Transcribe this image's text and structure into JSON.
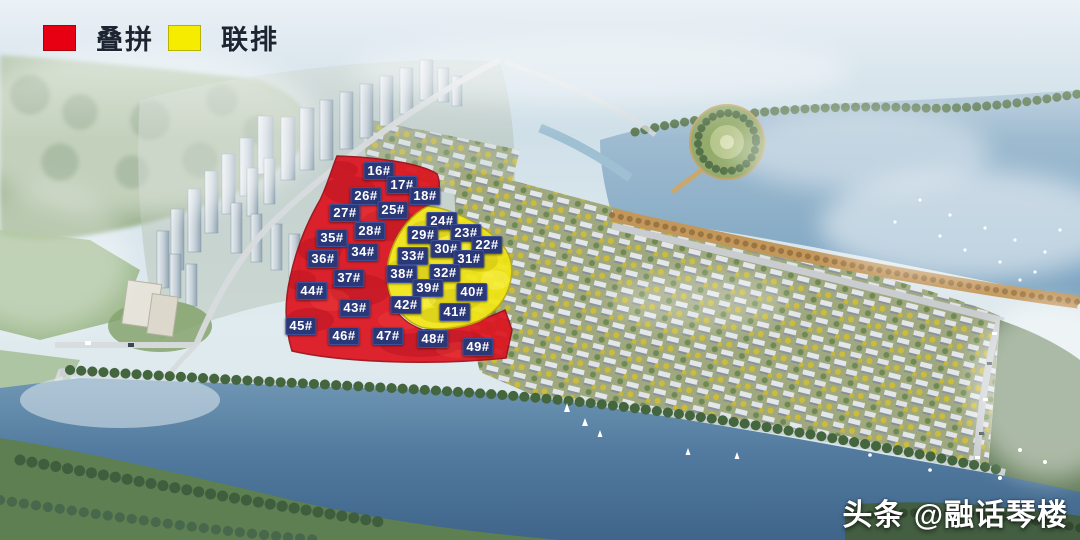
{
  "legend": {
    "items": [
      {
        "label": "叠拼",
        "color": "#e60012",
        "zone": "red"
      },
      {
        "label": "联排",
        "color": "#f5ec00",
        "zone": "yellow"
      }
    ]
  },
  "watermark": {
    "text": "头条 @融话琴楼"
  },
  "map": {
    "zone_colors": {
      "red": "#dc1420",
      "yellow": "#f2e713"
    },
    "label_style": {
      "bg": "#2b3878",
      "fg": "#ffffff"
    },
    "building_labels": [
      {
        "text": "16#",
        "x": 379,
        "y": 171,
        "zone": "red"
      },
      {
        "text": "17#",
        "x": 402,
        "y": 185,
        "zone": "red"
      },
      {
        "text": "26#",
        "x": 366,
        "y": 196,
        "zone": "red"
      },
      {
        "text": "18#",
        "x": 425,
        "y": 196,
        "zone": "red"
      },
      {
        "text": "25#",
        "x": 393,
        "y": 210,
        "zone": "red"
      },
      {
        "text": "27#",
        "x": 345,
        "y": 213,
        "zone": "red"
      },
      {
        "text": "24#",
        "x": 442,
        "y": 221,
        "zone": "yellow"
      },
      {
        "text": "28#",
        "x": 370,
        "y": 231,
        "zone": "red"
      },
      {
        "text": "29#",
        "x": 423,
        "y": 235,
        "zone": "yellow"
      },
      {
        "text": "23#",
        "x": 466,
        "y": 233,
        "zone": "yellow"
      },
      {
        "text": "35#",
        "x": 332,
        "y": 238,
        "zone": "red"
      },
      {
        "text": "22#",
        "x": 487,
        "y": 245,
        "zone": "yellow"
      },
      {
        "text": "30#",
        "x": 446,
        "y": 249,
        "zone": "yellow"
      },
      {
        "text": "34#",
        "x": 363,
        "y": 252,
        "zone": "red"
      },
      {
        "text": "33#",
        "x": 413,
        "y": 256,
        "zone": "yellow"
      },
      {
        "text": "36#",
        "x": 323,
        "y": 259,
        "zone": "red"
      },
      {
        "text": "31#",
        "x": 469,
        "y": 259,
        "zone": "yellow"
      },
      {
        "text": "32#",
        "x": 445,
        "y": 273,
        "zone": "yellow"
      },
      {
        "text": "38#",
        "x": 402,
        "y": 274,
        "zone": "yellow"
      },
      {
        "text": "37#",
        "x": 349,
        "y": 278,
        "zone": "red"
      },
      {
        "text": "39#",
        "x": 428,
        "y": 288,
        "zone": "yellow"
      },
      {
        "text": "44#",
        "x": 312,
        "y": 291,
        "zone": "red"
      },
      {
        "text": "40#",
        "x": 472,
        "y": 292,
        "zone": "yellow"
      },
      {
        "text": "42#",
        "x": 406,
        "y": 305,
        "zone": "yellow"
      },
      {
        "text": "43#",
        "x": 355,
        "y": 308,
        "zone": "red"
      },
      {
        "text": "41#",
        "x": 455,
        "y": 312,
        "zone": "yellow"
      },
      {
        "text": "45#",
        "x": 301,
        "y": 326,
        "zone": "red"
      },
      {
        "text": "46#",
        "x": 344,
        "y": 336,
        "zone": "red"
      },
      {
        "text": "47#",
        "x": 388,
        "y": 336,
        "zone": "red"
      },
      {
        "text": "48#",
        "x": 433,
        "y": 339,
        "zone": "red"
      },
      {
        "text": "49#",
        "x": 478,
        "y": 347,
        "zone": "red"
      }
    ]
  }
}
